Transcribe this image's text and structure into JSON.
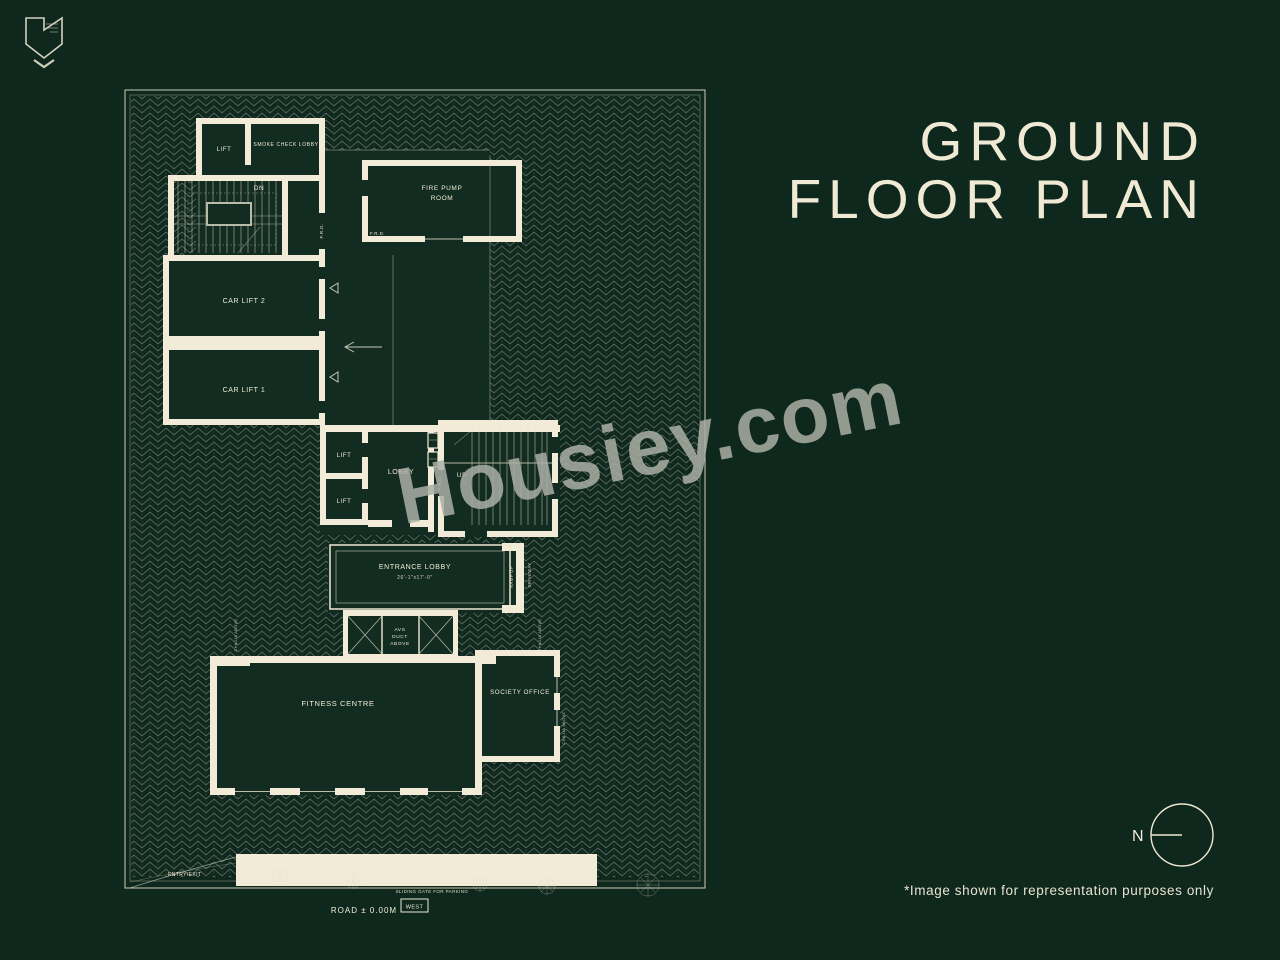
{
  "title": {
    "line1": "GROUND",
    "line2": "FLOOR PLAN"
  },
  "watermark": "Housiey.com",
  "north": {
    "label": "N"
  },
  "disclaimer": "*Image shown for representation purposes only",
  "plan": {
    "rooms": {
      "lift_top": "LIFT",
      "smoke_check_lobby": "SMOKE CHECK LOBBY",
      "stair_dn": "DN",
      "fire_pump_line1": "FIRE PUMP",
      "fire_pump_line2": "ROOM",
      "car_lift_2": "CAR LIFT 2",
      "car_lift_1": "CAR LIFT 1",
      "lift_mid_upper": "LIFT",
      "lift_mid_lower": "LIFT",
      "lobby": "LOBBY",
      "stair_up": "UP",
      "entrance_lobby": "ENTRANCE LOBBY",
      "entrance_lobby_dim": "26'-1\"x17'-0\"",
      "avs_line1": "AVS",
      "avs_line2": "DUCT",
      "avs_line3": "ABOVE",
      "fitness_centre": "FITNESS CENTRE",
      "society_office": "SOCIETY OFFICE"
    },
    "annotations": {
      "frd": "F.R.D.",
      "entry_exit": "ENTRY/EXIT",
      "sliding_gate": "SLIDING GATE FOR PARKING",
      "road_level": "ROAD ± 0.00M",
      "west": "WEST",
      "ramp_up": "RAMP UP",
      "driveway": "DRIVEWAY",
      "chajja": "CHAJJA ABOVE"
    }
  },
  "colors": {
    "background": "#0f281e",
    "room_fill": "#132c21",
    "wall_cream": "#f1ebd7",
    "hatch_line": "#ded8c2",
    "watermark_gray": "#aaafa6"
  }
}
